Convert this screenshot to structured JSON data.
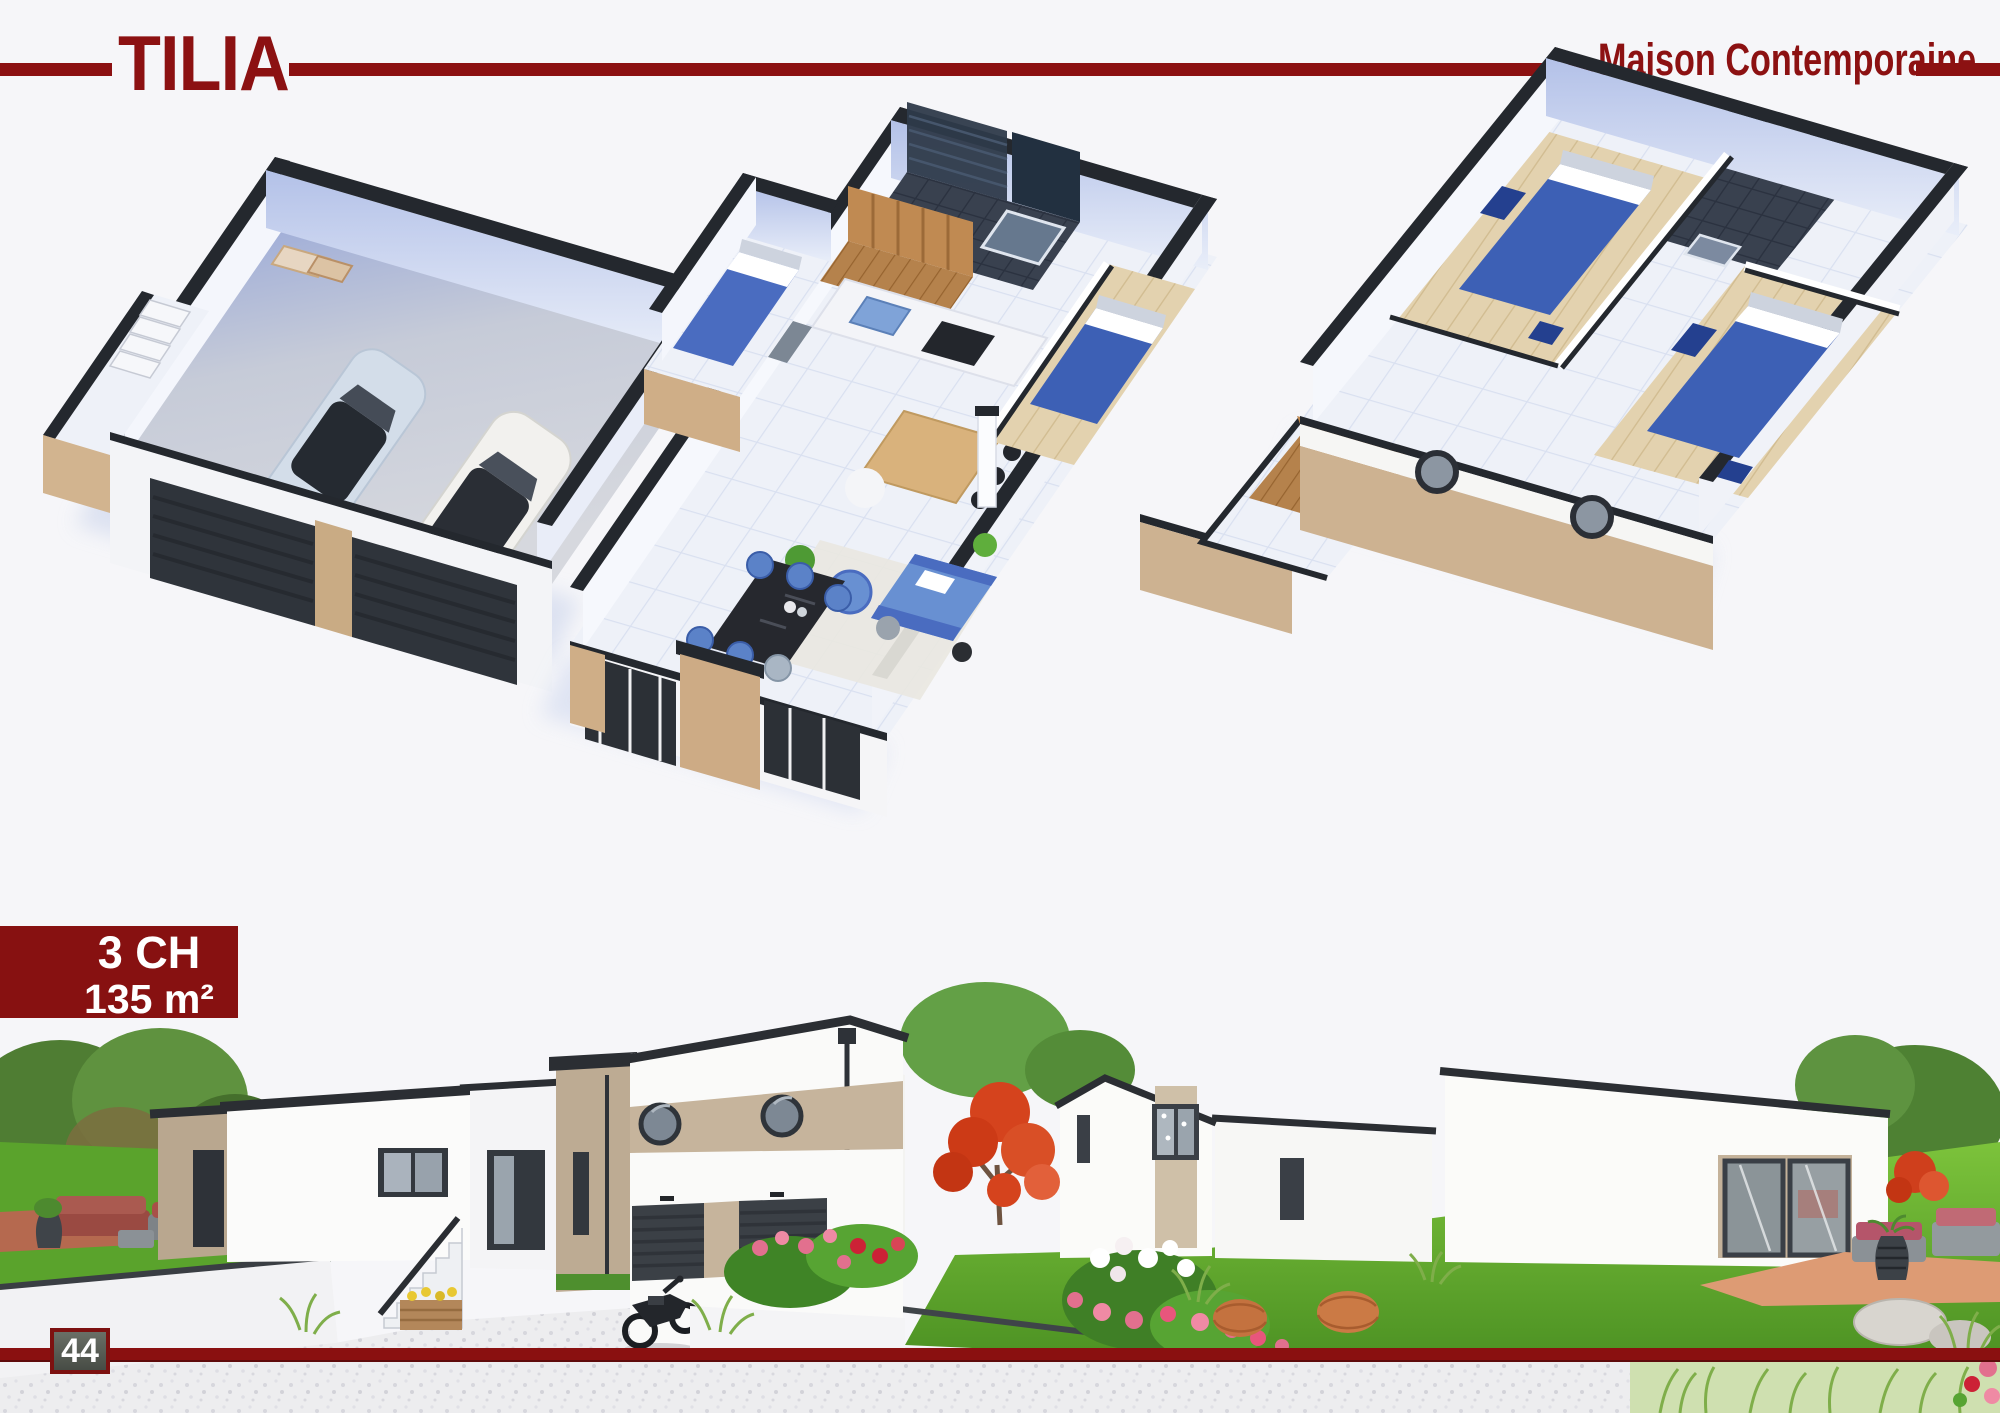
{
  "header": {
    "title": "TILIA",
    "tagline": "Maison Contemporaine",
    "accent_color": "#8c1112"
  },
  "badge": {
    "bedrooms": "3 CH",
    "area": "135 m²",
    "background_color": "#871111",
    "text_color": "#ffffff"
  },
  "footer": {
    "page_number": "44",
    "line_color": "#8a1010"
  },
  "scene": {
    "floorplan_sections": [
      "garage",
      "living-dining-kitchen",
      "bedrooms-bathroom"
    ],
    "exterior_views": [
      "front-elevation",
      "rear-garden"
    ],
    "palette": {
      "wall_cap": "#24282e",
      "beige": "#cdb291",
      "taupe_band": "#c6b49c",
      "furniture_blue": "#3d60b5",
      "grass": "#5aa32c",
      "wood": "#b5824c"
    }
  }
}
